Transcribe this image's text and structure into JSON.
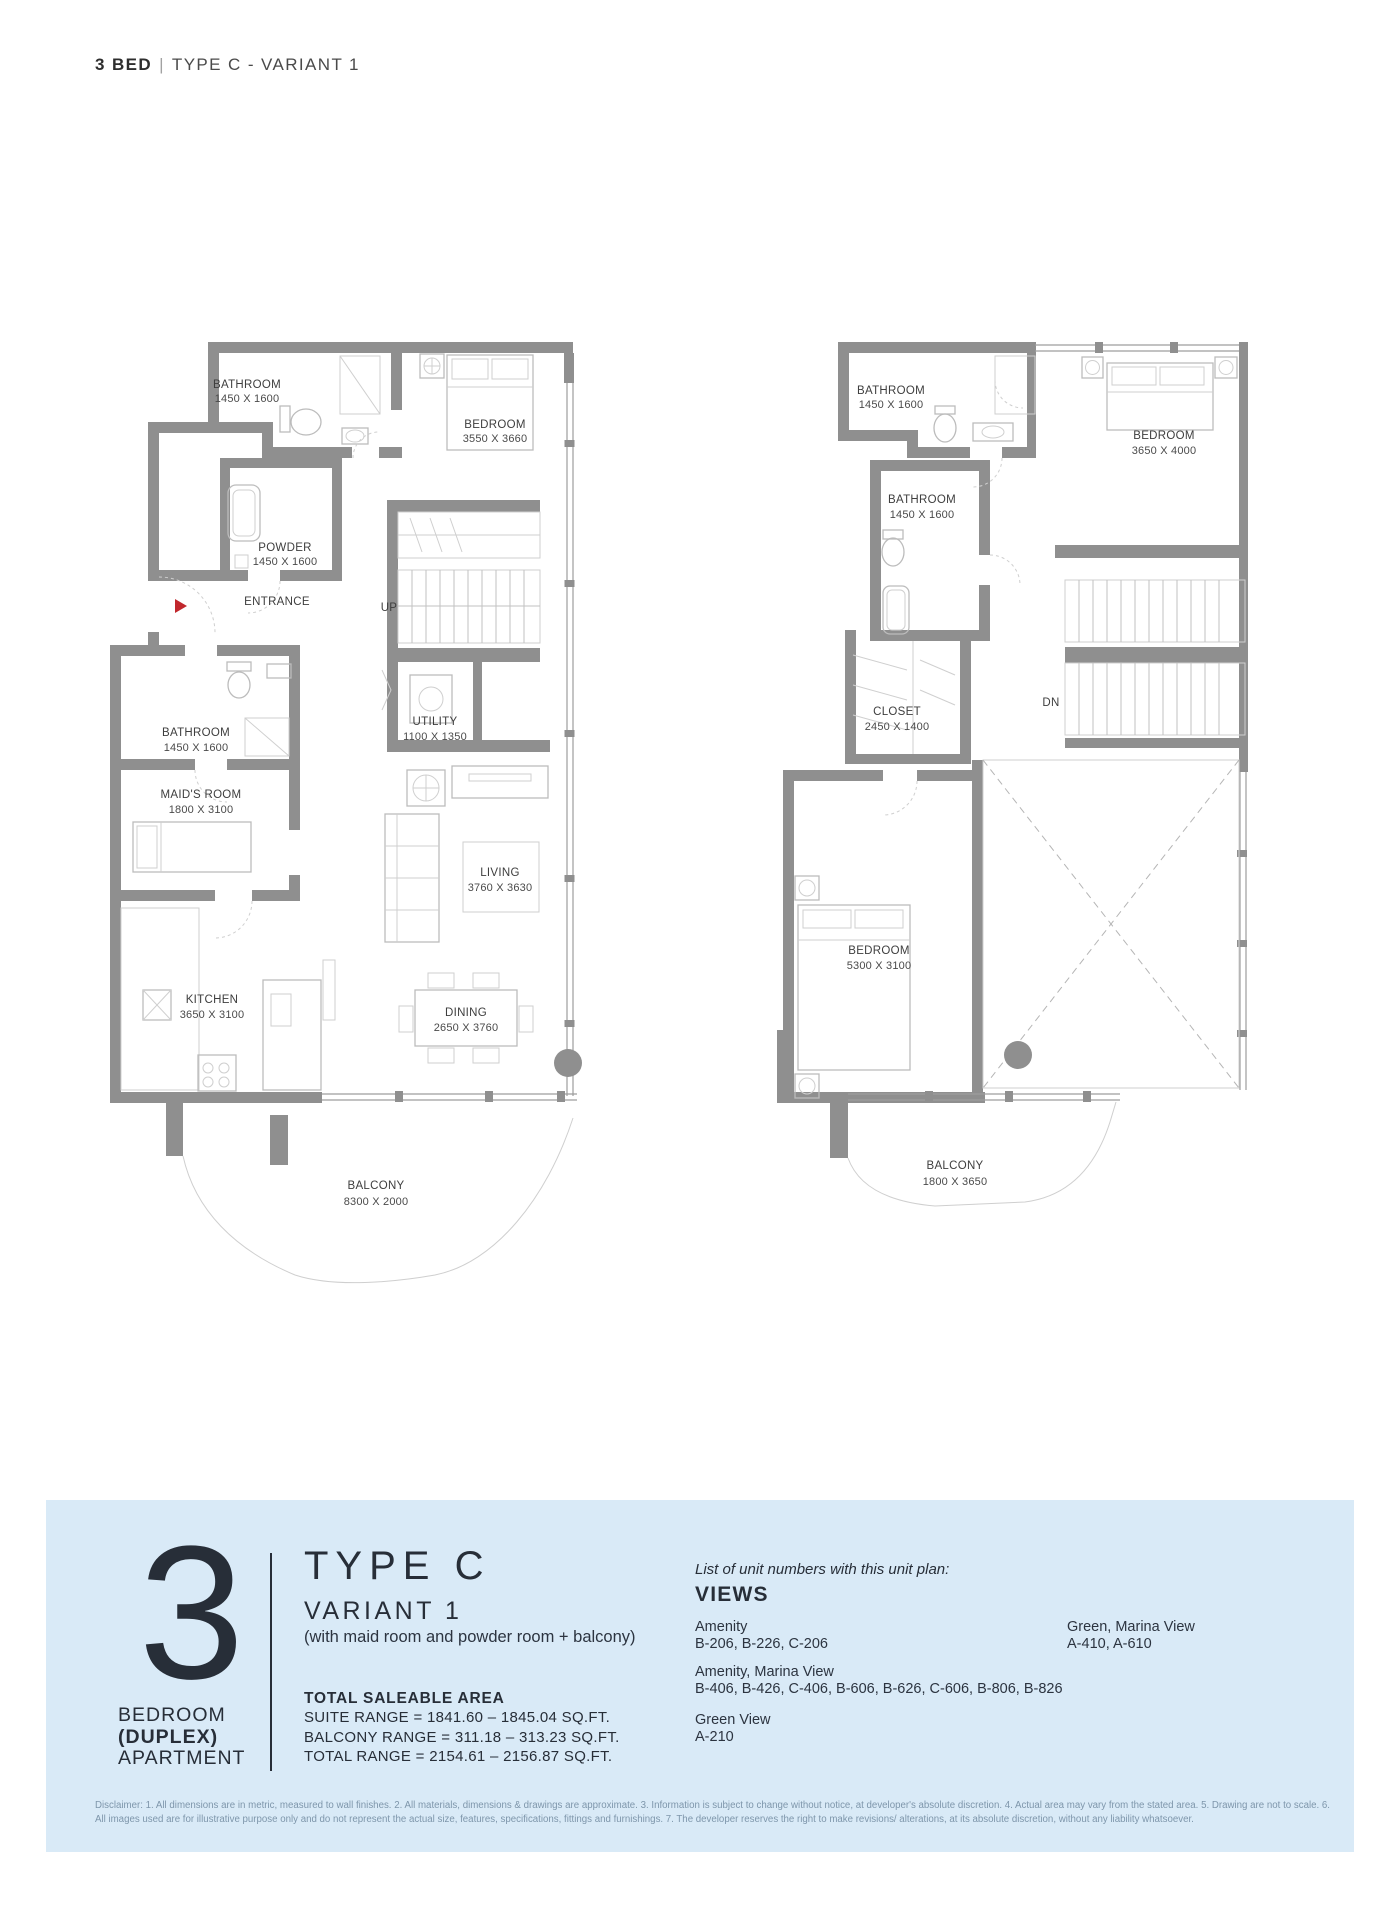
{
  "header": {
    "unit": "3 BED",
    "divider": "|",
    "type": "TYPE C - VARIANT 1"
  },
  "plans": {
    "lower": {
      "bathroom1": {
        "name": "BATHROOM",
        "dims": "1450 X 1600"
      },
      "bedroom": {
        "name": "BEDROOM",
        "dims": "3550 X 3660"
      },
      "powder": {
        "name": "POWDER",
        "dims": "1450 X 1600"
      },
      "entrance": "ENTRANCE",
      "stair": "UP",
      "utility": {
        "name": "UTILITY",
        "dims": "1100 X 1350"
      },
      "bathroom2": {
        "name": "BATHROOM",
        "dims": "1450 X 1600"
      },
      "maids": {
        "name": "MAID'S ROOM",
        "dims": "1800 X 3100"
      },
      "living": {
        "name": "LIVING",
        "dims": "3760 X 3630"
      },
      "kitchen": {
        "name": "KITCHEN",
        "dims": "3650 X 3100"
      },
      "dining": {
        "name": "DINING",
        "dims": "2650 X 3760"
      },
      "balcony": {
        "name": "BALCONY",
        "dims": "8300 X 2000"
      }
    },
    "upper": {
      "bathroom1": {
        "name": "BATHROOM",
        "dims": "1450 X 1600"
      },
      "bedroom1": {
        "name": "BEDROOM",
        "dims": "3650 X 4000"
      },
      "bathroom2": {
        "name": "BATHROOM",
        "dims": "1450 X 1600"
      },
      "closet": {
        "name": "CLOSET",
        "dims": "2450 X 1400"
      },
      "stair": "DN",
      "bedroom2": {
        "name": "BEDROOM",
        "dims": "5300 X 3100"
      },
      "balcony": {
        "name": "BALCONY",
        "dims": "1800 X 3650"
      }
    }
  },
  "panel": {
    "number": "3",
    "unit_type_lines": [
      "BEDROOM",
      "(DUPLEX)",
      "APARTMENT"
    ],
    "type_title": "TYPE C",
    "variant": "VARIANT 1",
    "variant_note": "(with maid room and powder room + balcony)",
    "area_title": "TOTAL SALEABLE AREA",
    "area_lines": [
      "SUITE RANGE = 1841.60 – 1845.04  SQ.FT.",
      "BALCONY RANGE = 311.18 – 313.23  SQ.FT.",
      "TOTAL RANGE = 2154.61 – 2156.87 SQ.FT."
    ],
    "views": {
      "intro": "List of unit numbers with this unit plan:",
      "title": "VIEWS",
      "groups": [
        {
          "label": "Amenity",
          "units": "B-206, B-226, C-206"
        },
        {
          "label": "Amenity, Marina View",
          "units": "B-406, B-426, C-406, B-606, B-626, C-606, B-806, B-826"
        },
        {
          "label": "Green View",
          "units": "A-210"
        },
        {
          "label": "Green, Marina View",
          "units": "A-410, A-610"
        }
      ]
    },
    "disclaimer": "Disclaimer: 1. All dimensions are in metric, measured to wall finishes. 2. All materials, dimensions & drawings are approximate. 3. Information is subject to change without notice, at developer's absolute discretion. 4. Actual area may vary from the stated area. 5. Drawing are not to scale. 6. All images used are for illustrative purpose only and do not represent the actual size, features, specifications, fittings and furnishings. 7. The developer reserves the right to make revisions/ alterations, at its absolute discretion, without any liability whatsoever."
  },
  "colors": {
    "panel_bg": "#d9eaf7",
    "wall_gray": "#8f8f8f",
    "entrance_arrow_red": "#c1272d",
    "text_dark": "#272e38",
    "disclaimer_blue": "#7e96ab"
  }
}
